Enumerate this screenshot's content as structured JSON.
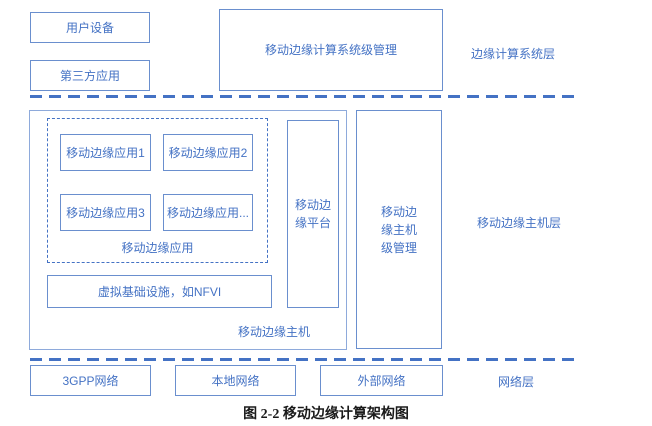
{
  "system_layer": {
    "layer_label": "边缘计算系统层",
    "user_device_label": "用户设备",
    "third_party_label": "第三方应用",
    "system_mgmt_label": "移动边缘计算系统级管理"
  },
  "host_layer": {
    "layer_label": "移动边缘主机层",
    "apps": [
      {
        "label": "移动边缘应用1"
      },
      {
        "label": "移动边缘应用2"
      },
      {
        "label": "移动边缘应用3"
      },
      {
        "label": "移动边缘应用..."
      }
    ],
    "apps_group_label": "移动边缘应用",
    "nfvi_label": "虚拟基础设施，如NFVI",
    "host_box_label": "移动边缘主机",
    "platform_label": "移动边缘平台",
    "host_mgmt_label": "移动边缘主机级管理"
  },
  "network_layer": {
    "layer_label": "网络层",
    "networks": [
      {
        "label": "3GPP网络"
      },
      {
        "label": "本地网络"
      },
      {
        "label": "外部网络"
      }
    ]
  },
  "caption": "图 2-2 移动边缘计算架构图",
  "colors": {
    "accent_blue": "#4472C4",
    "box_border": "#6A8FCE",
    "outer_border": "#8EAADB"
  }
}
